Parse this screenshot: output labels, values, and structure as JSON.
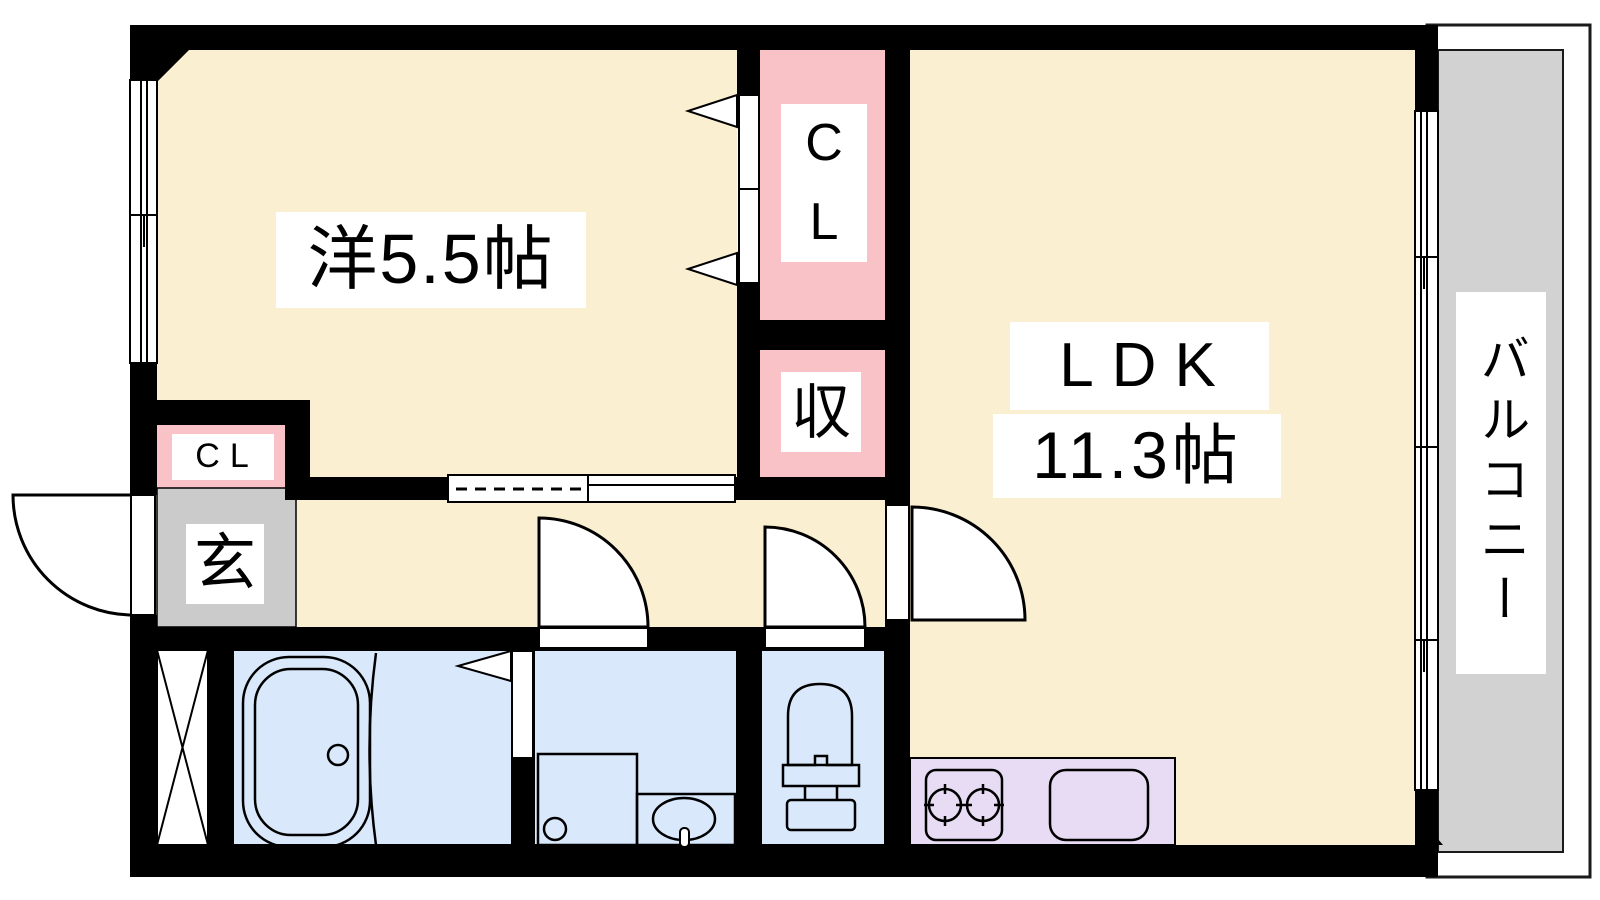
{
  "rooms": {
    "western": {
      "label": "洋5.5帖"
    },
    "ldk": {
      "name": "LDK",
      "size": "11.3帖"
    },
    "balcony": {
      "label": "バルコニー"
    },
    "closet_main": {
      "char1": "C",
      "char2": "L"
    },
    "storage": {
      "label": "収"
    },
    "closet_entry": {
      "label": "CL"
    },
    "entrance": {
      "label": "玄"
    }
  },
  "colors": {
    "room_cream": "#FBEFD2",
    "closet_pink": "#F9C2C6",
    "wet_blue": "#D9E8FA",
    "kitchen_purple": "#E7DCF3",
    "entrance_gray": "#CBCBCB",
    "balcony_gray": "#D2D2D2",
    "wall_black": "#000000"
  }
}
